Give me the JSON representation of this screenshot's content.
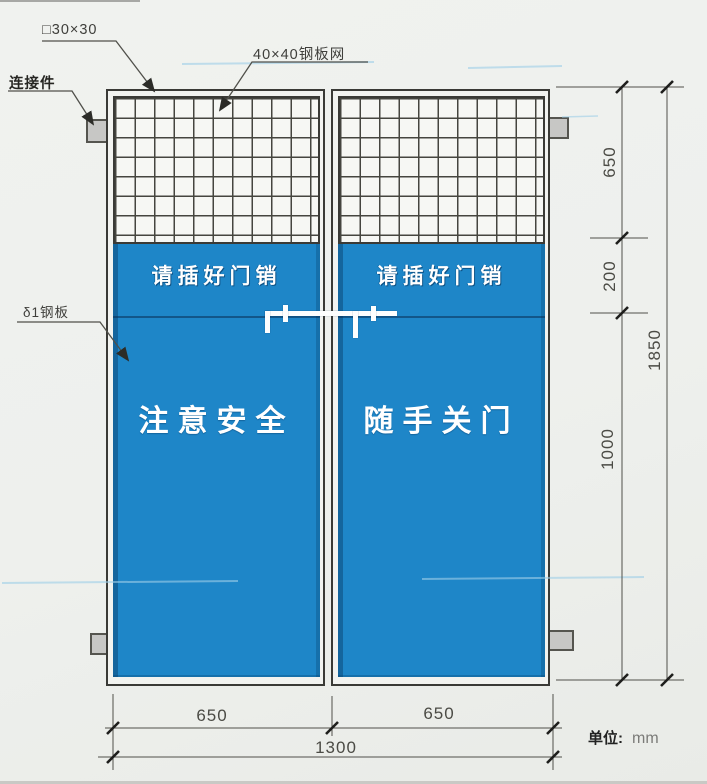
{
  "title": "建筑工地安全防护门 技术图",
  "callouts": {
    "tube": "□30×30",
    "mesh": "40×40钢板网",
    "connector": "连接件",
    "plate": "δ1钢板"
  },
  "doors": {
    "left": {
      "pin_notice": "请插好门销",
      "slogan": "注意安全"
    },
    "right": {
      "pin_notice": "请插好门销",
      "slogan": "随手关门"
    }
  },
  "dimensions": {
    "right_segments": [
      "650",
      "200",
      "1000"
    ],
    "right_overall": "1850",
    "bottom_segments": [
      "650",
      "650"
    ],
    "bottom_overall": "1300"
  },
  "unit": {
    "label": "单位:",
    "value": "mm"
  },
  "colors": {
    "door_blue": "#1e86c8",
    "panel_shadow_blue": "#135d93",
    "line": "#50504a",
    "tab_gray": "#c7c7c5",
    "paper": "#eef0ed",
    "scan_streak_blue": "#9ecfe8"
  }
}
